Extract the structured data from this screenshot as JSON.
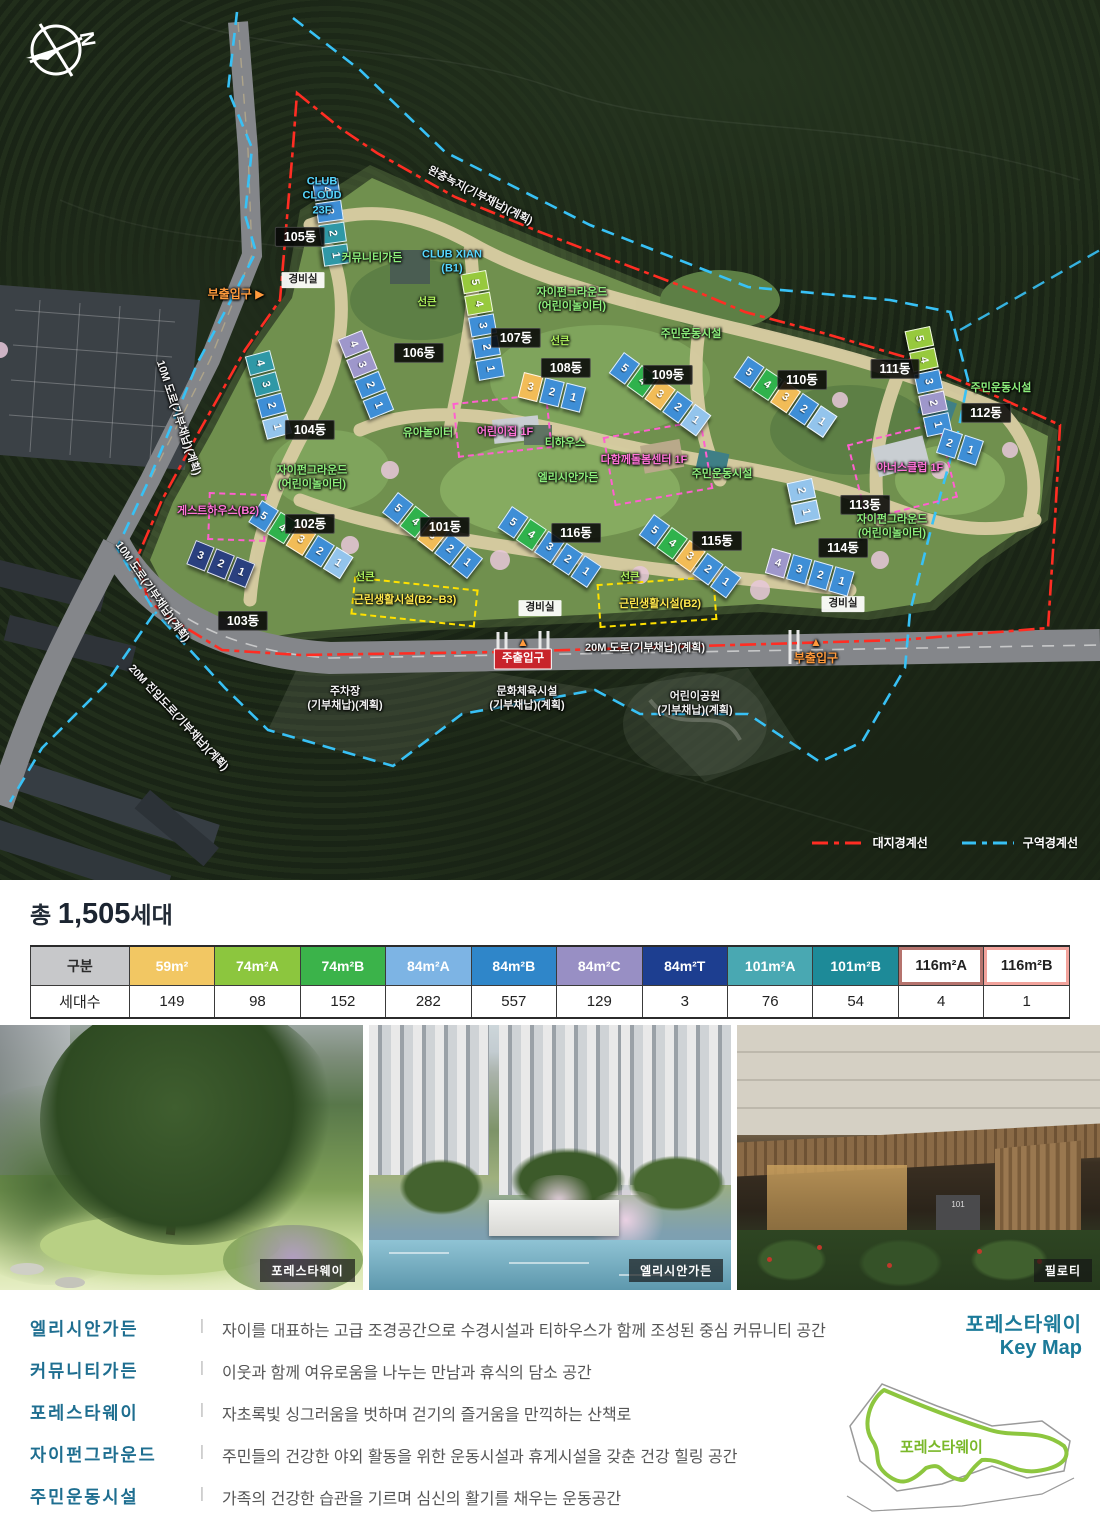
{
  "map": {
    "compass_letter": "N",
    "legend": [
      {
        "label": "대지경계선",
        "color": "#ff2d23"
      },
      {
        "label": "구역경계선",
        "color": "#38c1f5"
      }
    ],
    "seg_colors": {
      "B": "#3e8ed6",
      "LB": "#93c4ec",
      "T": "#2f98a6",
      "G": "#2fb24c",
      "LG": "#97c93d",
      "Y": "#f2bc57",
      "P": "#9e97cb",
      "N": "#2a407f"
    },
    "buildings": [
      {
        "name": "105동",
        "x": 338,
        "y": 178,
        "a": 82,
        "segs": [
          {
            "n": "4",
            "c": "B"
          },
          {
            "n": "3",
            "c": "B"
          },
          {
            "n": "2",
            "c": "T"
          },
          {
            "n": "1",
            "c": "T"
          }
        ]
      },
      {
        "name": "104동",
        "x": 270,
        "y": 350,
        "a": 75,
        "segs": [
          {
            "n": "4",
            "c": "T"
          },
          {
            "n": "3",
            "c": "T"
          },
          {
            "n": "2",
            "c": "B"
          },
          {
            "n": "1",
            "c": "LB"
          }
        ]
      },
      {
        "name": "106동",
        "x": 362,
        "y": 330,
        "a": 68,
        "segs": [
          {
            "n": "4",
            "c": "P"
          },
          {
            "n": "3",
            "c": "P"
          },
          {
            "n": "2",
            "c": "B"
          },
          {
            "n": "1",
            "c": "B"
          }
        ]
      },
      {
        "name": "107동",
        "x": 486,
        "y": 270,
        "a": 80,
        "segs": [
          {
            "n": "5",
            "c": "LG"
          },
          {
            "n": "4",
            "c": "LG"
          },
          {
            "n": "3",
            "c": "B"
          },
          {
            "n": "2",
            "c": "B"
          },
          {
            "n": "1",
            "c": "B"
          }
        ]
      },
      {
        "name": "108동",
        "x": 524,
        "y": 372,
        "a": 14,
        "segs": [
          {
            "n": "3",
            "c": "Y"
          },
          {
            "n": "2",
            "c": "B"
          },
          {
            "n": "1",
            "c": "B"
          }
        ]
      },
      {
        "name": "109동",
        "x": 624,
        "y": 352,
        "a": 36,
        "segs": [
          {
            "n": "5",
            "c": "B"
          },
          {
            "n": "4",
            "c": "G"
          },
          {
            "n": "3",
            "c": "Y"
          },
          {
            "n": "2",
            "c": "B"
          },
          {
            "n": "1",
            "c": "LB"
          }
        ]
      },
      {
        "name": "110동",
        "x": 748,
        "y": 356,
        "a": 34,
        "segs": [
          {
            "n": "5",
            "c": "B"
          },
          {
            "n": "4",
            "c": "G"
          },
          {
            "n": "3",
            "c": "Y"
          },
          {
            "n": "2",
            "c": "B"
          },
          {
            "n": "1",
            "c": "LB"
          }
        ]
      },
      {
        "name": "111동",
        "x": 930,
        "y": 326,
        "a": 78,
        "segs": [
          {
            "n": "5",
            "c": "LG"
          },
          {
            "n": "4",
            "c": "LG"
          },
          {
            "n": "3",
            "c": "B"
          },
          {
            "n": "2",
            "c": "P"
          },
          {
            "n": "1",
            "c": "B"
          }
        ]
      },
      {
        "name": "112동",
        "x": 944,
        "y": 428,
        "a": 18,
        "segs": [
          {
            "n": "2",
            "c": "B"
          },
          {
            "n": "1",
            "c": "B"
          }
        ]
      },
      {
        "name": "113동",
        "x": 812,
        "y": 478,
        "a": 78,
        "segs": [
          {
            "n": "2",
            "c": "LB"
          },
          {
            "n": "1",
            "c": "LB"
          }
        ]
      },
      {
        "name": "114동",
        "x": 772,
        "y": 548,
        "a": 16,
        "segs": [
          {
            "n": "4",
            "c": "P"
          },
          {
            "n": "3",
            "c": "B"
          },
          {
            "n": "2",
            "c": "B"
          },
          {
            "n": "1",
            "c": "B"
          }
        ]
      },
      {
        "name": "115동",
        "x": 654,
        "y": 514,
        "a": 36,
        "segs": [
          {
            "n": "5",
            "c": "B"
          },
          {
            "n": "4",
            "c": "G"
          },
          {
            "n": "3",
            "c": "Y"
          },
          {
            "n": "2",
            "c": "B"
          },
          {
            "n": "1",
            "c": "B"
          }
        ]
      },
      {
        "name": "116동",
        "x": 512,
        "y": 506,
        "a": 34,
        "segs": [
          {
            "n": "5",
            "c": "B"
          },
          {
            "n": "4",
            "c": "G"
          },
          {
            "n": "3",
            "c": "B"
          },
          {
            "n": "2",
            "c": "B"
          },
          {
            "n": "1",
            "c": "B"
          }
        ]
      },
      {
        "name": "101동",
        "x": 398,
        "y": 492,
        "a": 38,
        "segs": [
          {
            "n": "5",
            "c": "B"
          },
          {
            "n": "4",
            "c": "G"
          },
          {
            "n": "3",
            "c": "Y"
          },
          {
            "n": "2",
            "c": "B"
          },
          {
            "n": "1",
            "c": "B"
          }
        ]
      },
      {
        "name": "102동",
        "x": 262,
        "y": 500,
        "a": 32,
        "segs": [
          {
            "n": "5",
            "c": "B"
          },
          {
            "n": "4",
            "c": "G"
          },
          {
            "n": "3",
            "c": "Y"
          },
          {
            "n": "2",
            "c": "B"
          },
          {
            "n": "1",
            "c": "LB"
          }
        ]
      },
      {
        "name": "103동",
        "x": 196,
        "y": 540,
        "a": 22,
        "segs": [
          {
            "n": "3",
            "c": "N"
          },
          {
            "n": "2",
            "c": "N"
          },
          {
            "n": "1",
            "c": "N"
          }
        ]
      }
    ],
    "boxes": [
      {
        "x": 455,
        "y": 398,
        "w": 95,
        "h": 55,
        "r": -6,
        "c": "#ff5fd0"
      },
      {
        "x": 608,
        "y": 428,
        "w": 100,
        "h": 70,
        "r": -10,
        "c": "#ff5fd0"
      },
      {
        "x": 855,
        "y": 432,
        "w": 95,
        "h": 78,
        "r": -14,
        "c": "#ff5fd0"
      },
      {
        "x": 208,
        "y": 493,
        "w": 58,
        "h": 48,
        "r": 2,
        "c": "#ff5fd0"
      },
      {
        "x": 352,
        "y": 583,
        "w": 125,
        "h": 38,
        "r": 6,
        "c": "#ffe100"
      },
      {
        "x": 598,
        "y": 580,
        "w": 118,
        "h": 44,
        "r": -4,
        "c": "#ffe100"
      }
    ],
    "labels": [
      {
        "t": "CLUB\nCLOUD\n23F",
        "x": 322,
        "y": 196,
        "c": "cyan"
      },
      {
        "t": "105동",
        "x": 300,
        "y": 237,
        "c": "dong"
      },
      {
        "t": "완충녹지(기부채납)(계획)",
        "x": 480,
        "y": 196,
        "c": "white",
        "r": 27
      },
      {
        "t": "커뮤니티가든",
        "x": 372,
        "y": 258,
        "c": "green"
      },
      {
        "t": "CLUB XIAN\n(B1)",
        "x": 452,
        "y": 262,
        "c": "cyan"
      },
      {
        "t": "경비실",
        "x": 303,
        "y": 280,
        "c": "wbadge"
      },
      {
        "t": "부출입구 ▶",
        "x": 236,
        "y": 295,
        "c": "orange"
      },
      {
        "t": "선큰",
        "x": 427,
        "y": 303,
        "c": "greenb"
      },
      {
        "t": "자이펀그라운드\n(어린이놀이터)",
        "x": 572,
        "y": 300,
        "c": "green"
      },
      {
        "t": "주민운동시설",
        "x": 691,
        "y": 334,
        "c": "green"
      },
      {
        "t": "선큰",
        "x": 560,
        "y": 342,
        "c": "greenb"
      },
      {
        "t": "107동",
        "x": 516,
        "y": 338,
        "c": "dong"
      },
      {
        "t": "106동",
        "x": 419,
        "y": 353,
        "c": "dong"
      },
      {
        "t": "108동",
        "x": 566,
        "y": 368,
        "c": "dong"
      },
      {
        "t": "109동",
        "x": 668,
        "y": 375,
        "c": "dong"
      },
      {
        "t": "110동",
        "x": 802,
        "y": 380,
        "c": "dong"
      },
      {
        "t": "111동",
        "x": 895,
        "y": 369,
        "c": "dong"
      },
      {
        "t": "주민운동시설",
        "x": 1001,
        "y": 388,
        "c": "green"
      },
      {
        "t": "112동",
        "x": 986,
        "y": 413,
        "c": "dong"
      },
      {
        "t": "104동",
        "x": 310,
        "y": 430,
        "c": "dong"
      },
      {
        "t": "10M 도로(기부채납)(계획)",
        "x": 178,
        "y": 418,
        "c": "white",
        "r": 72
      },
      {
        "t": "유아놀이터",
        "x": 428,
        "y": 433,
        "c": "green"
      },
      {
        "t": "어린이집 1F",
        "x": 505,
        "y": 432,
        "c": "pink"
      },
      {
        "t": "티하우스",
        "x": 565,
        "y": 443,
        "c": "green"
      },
      {
        "t": "다함께돌봄센터 1F",
        "x": 644,
        "y": 460,
        "c": "pink"
      },
      {
        "t": "주민운동시설",
        "x": 722,
        "y": 474,
        "c": "green"
      },
      {
        "t": "엘리시안가든",
        "x": 568,
        "y": 478,
        "c": "green"
      },
      {
        "t": "아너스클럽 1F",
        "x": 910,
        "y": 468,
        "c": "pink"
      },
      {
        "t": "자이펀그라운드\n(어린이놀이터)",
        "x": 312,
        "y": 478,
        "c": "green"
      },
      {
        "t": "게스트하우스(B2)",
        "x": 218,
        "y": 511,
        "c": "pink"
      },
      {
        "t": "113동",
        "x": 865,
        "y": 505,
        "c": "dong"
      },
      {
        "t": "102동",
        "x": 310,
        "y": 524,
        "c": "dong"
      },
      {
        "t": "101동",
        "x": 445,
        "y": 527,
        "c": "dong"
      },
      {
        "t": "116동",
        "x": 576,
        "y": 533,
        "c": "dong"
      },
      {
        "t": "115동",
        "x": 717,
        "y": 541,
        "c": "dong"
      },
      {
        "t": "자이펀그라운드\n(어린이놀이터)",
        "x": 892,
        "y": 527,
        "c": "green"
      },
      {
        "t": "114동",
        "x": 843,
        "y": 548,
        "c": "dong"
      },
      {
        "t": "선큰",
        "x": 365,
        "y": 578,
        "c": "greenb"
      },
      {
        "t": "근린생활시설(B2~B3)",
        "x": 405,
        "y": 600,
        "c": "yellow"
      },
      {
        "t": "선큰",
        "x": 630,
        "y": 578,
        "c": "greenb"
      },
      {
        "t": "근린생활시설(B2)",
        "x": 660,
        "y": 604,
        "c": "yellow"
      },
      {
        "t": "경비실",
        "x": 540,
        "y": 608,
        "c": "wbadge"
      },
      {
        "t": "경비실",
        "x": 843,
        "y": 604,
        "c": "wbadge"
      },
      {
        "t": "103동",
        "x": 243,
        "y": 621,
        "c": "dong"
      },
      {
        "t": "10M 도로(기부채납)(계획)",
        "x": 152,
        "y": 592,
        "c": "white",
        "r": 55
      },
      {
        "t": "▲",
        "x": 523,
        "y": 643,
        "c": "orange"
      },
      {
        "t": "주출입구",
        "x": 523,
        "y": 659,
        "c": "redbadge"
      },
      {
        "t": "20M 도로(기부채납)(계획)",
        "x": 645,
        "y": 648,
        "c": "white"
      },
      {
        "t": "▲",
        "x": 816,
        "y": 643,
        "c": "orange"
      },
      {
        "t": "부출입구",
        "x": 816,
        "y": 659,
        "c": "orange"
      },
      {
        "t": "주차장\n(기부채납)(계획)",
        "x": 345,
        "y": 699,
        "c": "white"
      },
      {
        "t": "문화체육시설\n(기부채납)(계획)",
        "x": 527,
        "y": 699,
        "c": "white"
      },
      {
        "t": "어린이공원\n(기부채납)(계획)",
        "x": 695,
        "y": 704,
        "c": "white"
      },
      {
        "t": "20M 진입도로(기부채납)(계획)",
        "x": 178,
        "y": 718,
        "c": "white",
        "r": 47
      }
    ]
  },
  "summary": {
    "title_prefix": "총",
    "title_count": "1,505",
    "title_suffix": "세대",
    "table": {
      "header_label": "구분",
      "row_label": "세대수",
      "columns": [
        {
          "label": "59m²",
          "color": "#f2c763",
          "value": "149"
        },
        {
          "label": "74m²A",
          "color": "#8cc63e",
          "value": "98"
        },
        {
          "label": "74m²B",
          "color": "#3bb34a",
          "value": "152"
        },
        {
          "label": "84m²A",
          "color": "#7db4e4",
          "value": "282"
        },
        {
          "label": "84m²B",
          "color": "#2f86c9",
          "value": "557"
        },
        {
          "label": "84m²C",
          "color": "#988fc4",
          "value": "129"
        },
        {
          "label": "84m²T",
          "color": "#1d3e90",
          "value": "3"
        },
        {
          "label": "101m²A",
          "color": "#49a8b2",
          "value": "76"
        },
        {
          "label": "101m²B",
          "color": "#1d8a98",
          "value": "54"
        },
        {
          "label": "116m²A",
          "color": "#ffffff",
          "border": "#b5736d",
          "value": "4"
        },
        {
          "label": "116m²B",
          "color": "#ffffff",
          "border": "#f2a39c",
          "value": "1"
        }
      ]
    }
  },
  "photos": [
    {
      "caption": "포레스타웨이"
    },
    {
      "caption": "엘리시안가든"
    },
    {
      "caption": "필로티"
    }
  ],
  "descriptions": [
    {
      "term": "엘리시안가든",
      "divider": "|",
      "desc": "자이를 대표하는 고급 조경공간으로 수경시설과 티하우스가 함께 조성된 중심 커뮤니티 공간"
    },
    {
      "term": "커뮤니티가든",
      "divider": "|",
      "desc": "이웃과 함께 여유로움을 나누는 만남과 휴식의 담소 공간"
    },
    {
      "term": "포레스타웨이",
      "divider": "|",
      "desc": "자초록빛 싱그러움을 벗하며 걷기의 즐거움을 만끽하는 산책로"
    },
    {
      "term": "자이펀그라운드",
      "divider": "|",
      "desc": "주민들의 건강한 야외 활동을 위한 운동시설과 휴게시설을 갖춘 건강 힐링 공간"
    },
    {
      "term": "주민운동시설",
      "divider": "|",
      "desc": "가족의 건강한 습관을 기르며 심신의 활기를 채우는 운동공간"
    }
  ],
  "keymap": {
    "title": "포레스타웨이",
    "subtitle": "Key Map",
    "label": "포레스타웨이"
  }
}
